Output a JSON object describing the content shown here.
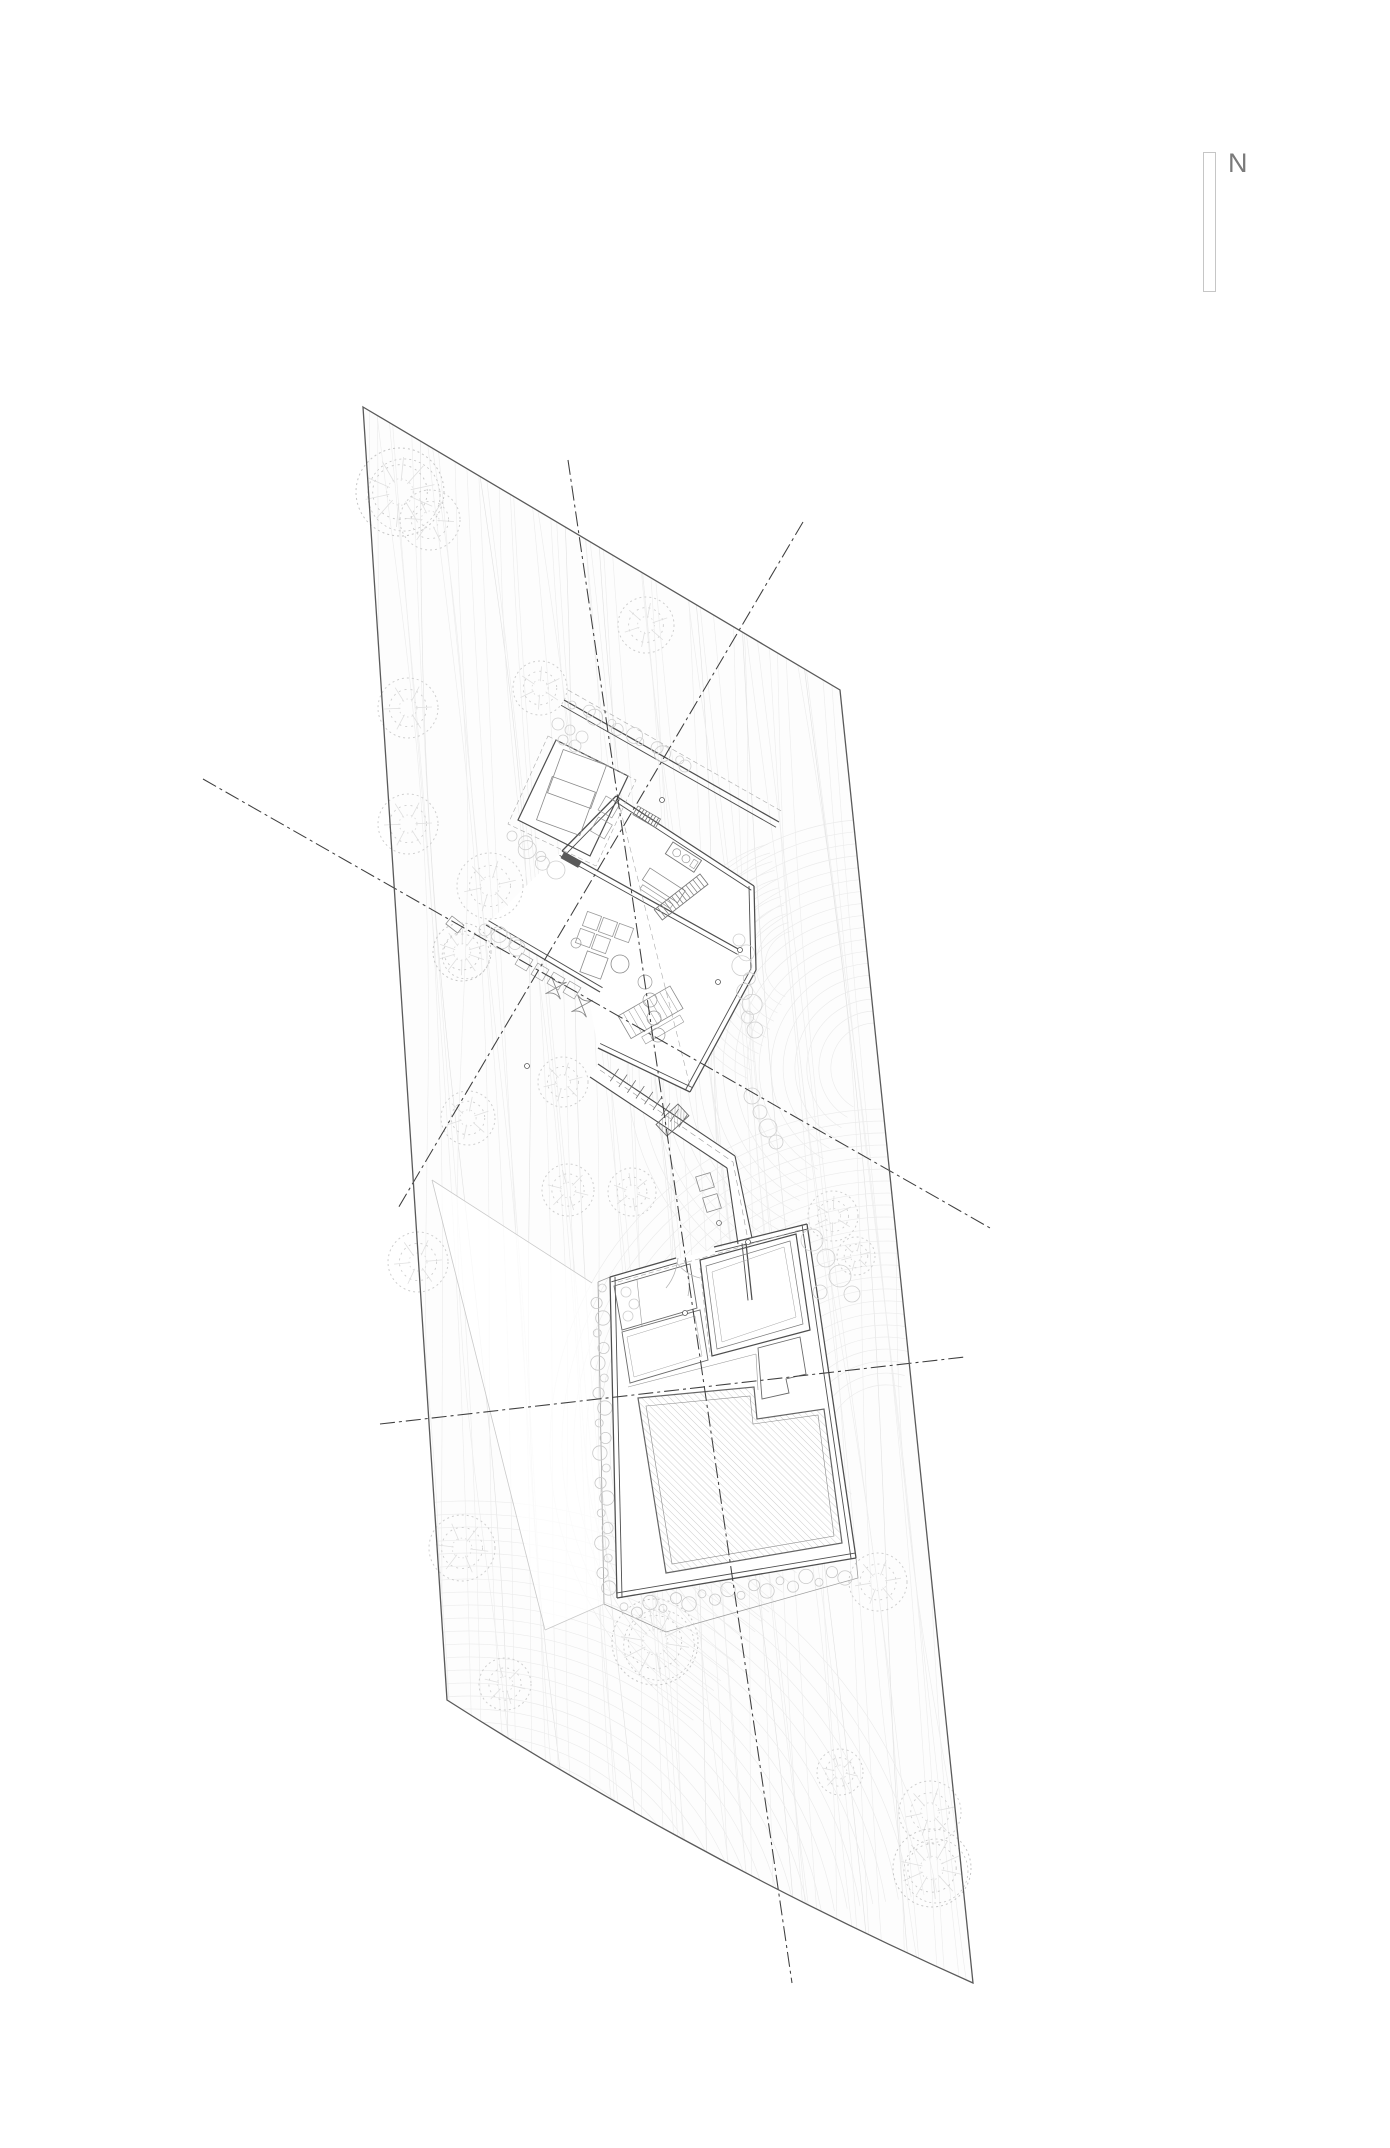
{
  "drawing": {
    "type": "architectural-site-plan",
    "title": "Site plan",
    "north": {
      "label": "N"
    },
    "site": {
      "shape": "irregular-quadrilateral",
      "features": [
        "topographic-contours",
        "trees",
        "house-with-two-splayed-wings",
        "stepped-walkway",
        "walled-courtyard",
        "hatched-pool",
        "pebble-border",
        "axis-lines"
      ]
    },
    "palette": {
      "background": "#ffffff",
      "boundary": "#5a5a5a",
      "walls": "#4e4e4e",
      "contours": "#ededed",
      "contours_accent": "#e2e2e2",
      "vegetation": "#cfcfcf",
      "furniture": "#9a9a9a",
      "axis": "#3f3f3f",
      "north_label": "#7a7a7a",
      "north_frame": "#c6c6c6",
      "pool_hatch": "#b8b8b8",
      "dark_fill": "#5a5a5a"
    }
  }
}
